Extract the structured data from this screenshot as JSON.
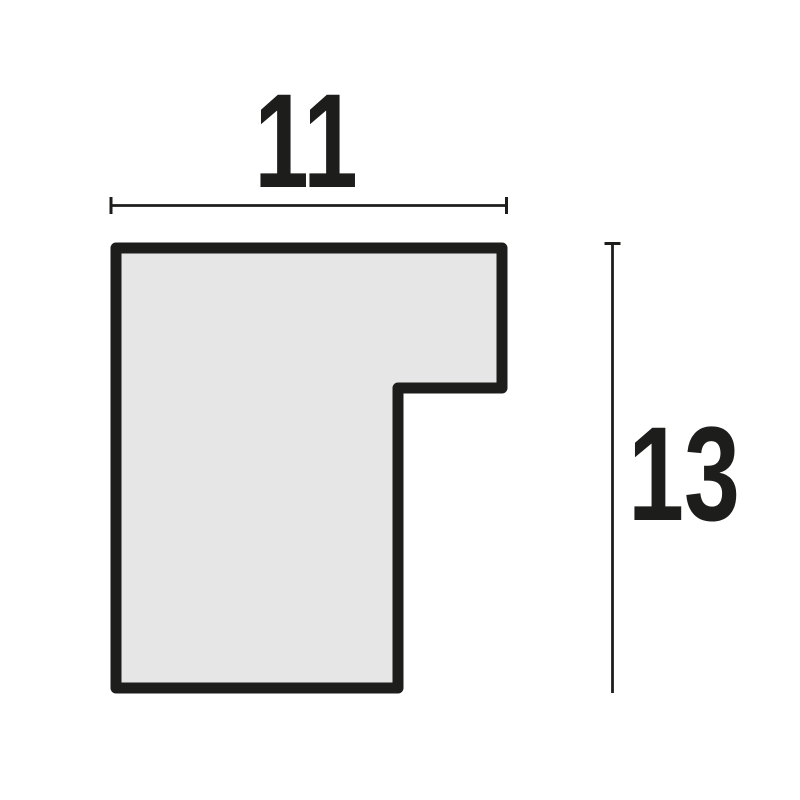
{
  "diagram": {
    "kind": "profile-cross-section-drawing",
    "width_dimension": {
      "label": "11"
    },
    "height_dimension": {
      "label": "13"
    },
    "colors": {
      "outline": "#1d1d1b",
      "fill": "#e6e6e6",
      "dimension": "#1d1d1b",
      "background": "#ffffff"
    }
  }
}
